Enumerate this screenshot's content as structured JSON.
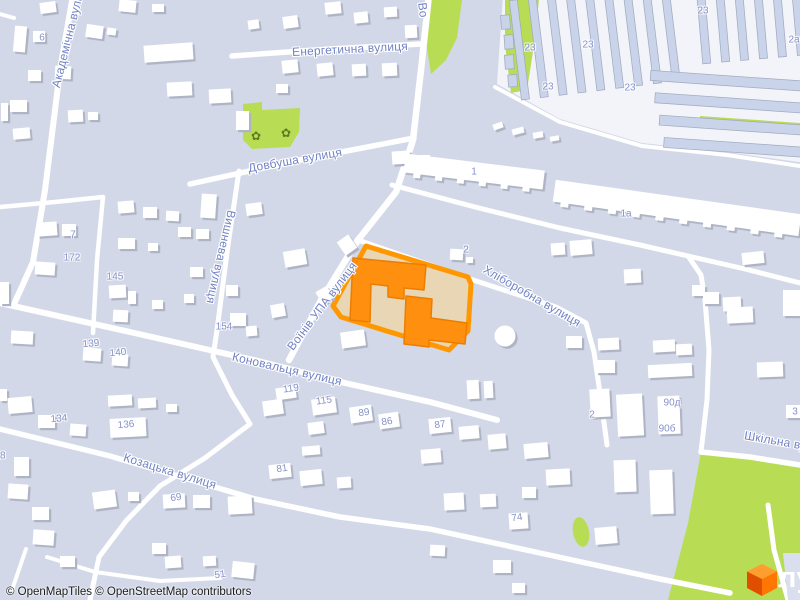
{
  "map": {
    "attribution": "© OpenMapTiles © OpenStreetMap contributors",
    "logo": {
      "text": "лун",
      "cube_icon": "lun-cube-icon"
    },
    "colors": {
      "land": "#d2d8e8",
      "road": "#ffffff",
      "green": "#b9dc55",
      "building": "#ffffff",
      "building_shadow": "#aeb4c4",
      "industrial_building": "#c9d3ea",
      "industrial_ground": "#f2f4f9",
      "plot_fill": "#e9d6b4",
      "plot_stroke": "#ff9800",
      "highlight_building": "#ff8f0f",
      "street_label": "#7283c4",
      "house_number": "#8792c9",
      "logo_orange": "#ff6b00"
    },
    "streets": [
      {
        "label": "Академічна вулиця",
        "x": 69,
        "y": 34,
        "r": -76
      },
      {
        "label": "Енергетична вулиця",
        "x": 350,
        "y": 49,
        "r": -3
      },
      {
        "label": "Довбуша вулиця",
        "x": 295,
        "y": 160,
        "r": -10
      },
      {
        "label": "Во",
        "x": 423,
        "y": 10,
        "r": 83
      },
      {
        "label": "Воїнів УПА вулиця",
        "x": 322,
        "y": 306,
        "r": -53
      },
      {
        "label": "Вишнева вулиця",
        "x": 221,
        "y": 257,
        "r": 103
      },
      {
        "label": "Хліборобна вулиця",
        "x": 532,
        "y": 296,
        "r": 30
      },
      {
        "label": "Коновальця вулиця",
        "x": 287,
        "y": 369,
        "r": 13
      },
      {
        "label": "Козацька вулиця",
        "x": 170,
        "y": 471,
        "r": 17
      },
      {
        "label": "Шкільна вулиця",
        "x": 789,
        "y": 443,
        "r": 10
      }
    ],
    "house_numbers": [
      {
        "label": "6",
        "x": 42,
        "y": 38,
        "r": 0
      },
      {
        "label": "7",
        "x": 73,
        "y": 235,
        "r": 0
      },
      {
        "label": "172",
        "x": 72,
        "y": 258,
        "r": 0
      },
      {
        "label": "145",
        "x": 115,
        "y": 277,
        "r": 0
      },
      {
        "label": "154",
        "x": 224,
        "y": 327,
        "r": 0
      },
      {
        "label": "139",
        "x": 91,
        "y": 344,
        "r": -5
      },
      {
        "label": "140",
        "x": 118,
        "y": 353,
        "r": -5
      },
      {
        "label": "134",
        "x": 59,
        "y": 419,
        "r": -5
      },
      {
        "label": "136",
        "x": 126,
        "y": 425,
        "r": -5
      },
      {
        "label": "119",
        "x": 291,
        "y": 389,
        "r": -8
      },
      {
        "label": "115",
        "x": 324,
        "y": 401,
        "r": -8
      },
      {
        "label": "89",
        "x": 364,
        "y": 413,
        "r": -8
      },
      {
        "label": "86",
        "x": 387,
        "y": 422,
        "r": -8
      },
      {
        "label": "87",
        "x": 440,
        "y": 425,
        "r": -8
      },
      {
        "label": "81",
        "x": 282,
        "y": 469,
        "r": -8
      },
      {
        "label": "69",
        "x": 176,
        "y": 498,
        "r": -8
      },
      {
        "label": "74",
        "x": 517,
        "y": 518,
        "r": -8
      },
      {
        "label": "51",
        "x": 220,
        "y": 575,
        "r": -8
      },
      {
        "label": "28",
        "x": 0,
        "y": 456,
        "r": 0
      },
      {
        "label": "1",
        "x": 474,
        "y": 172,
        "r": 0
      },
      {
        "label": "1а",
        "x": 626,
        "y": 214,
        "r": 0
      },
      {
        "label": "2",
        "x": 466,
        "y": 250,
        "r": 0
      },
      {
        "label": "2а",
        "x": 794,
        "y": 40,
        "r": 0
      },
      {
        "label": "23",
        "x": 530,
        "y": 48,
        "r": 0
      },
      {
        "label": "23",
        "x": 588,
        "y": 45,
        "r": 0
      },
      {
        "label": "23",
        "x": 703,
        "y": 11,
        "r": 0
      },
      {
        "label": "23",
        "x": 548,
        "y": 87,
        "r": 0
      },
      {
        "label": "23",
        "x": 630,
        "y": 88,
        "r": 0
      },
      {
        "label": "90д",
        "x": 672,
        "y": 403,
        "r": 0
      },
      {
        "label": "90б",
        "x": 667,
        "y": 429,
        "r": 0
      },
      {
        "label": "3",
        "x": 795,
        "y": 412,
        "r": 0
      },
      {
        "label": "2",
        "x": 592,
        "y": 415,
        "r": 0
      }
    ],
    "pois": [
      {
        "icon": "flower-icon",
        "glyph": "✿",
        "x": 256,
        "y": 136
      },
      {
        "icon": "flower-icon",
        "glyph": "✿",
        "x": 286,
        "y": 133
      }
    ]
  }
}
